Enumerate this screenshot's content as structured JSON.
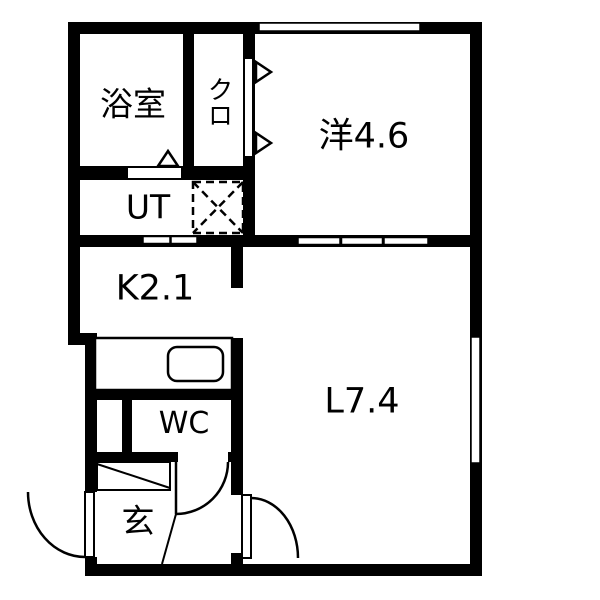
{
  "title": "apartment-floorplan",
  "colors": {
    "wall": "#000000",
    "background": "#ffffff",
    "line": "#000000"
  },
  "rooms": {
    "bathroom": {
      "label": "浴室"
    },
    "closet": {
      "label": "クロ"
    },
    "western_room": {
      "label": "洋4.6"
    },
    "utility": {
      "label": "UT"
    },
    "kitchen": {
      "label": "K2.1"
    },
    "living": {
      "label": "L7.4"
    },
    "toilet": {
      "label": "WC"
    },
    "entrance": {
      "label": "玄"
    }
  },
  "fixtures": {
    "kitchen_sink": "kitchen-sink-icon",
    "washing_machine_space": "washing-machine-cross-box",
    "entrance_door": "swing-door-arc",
    "toilet_door": "swing-door-arc",
    "living_door": "swing-door-arc",
    "bath_door": "triangle-door-mark",
    "closet_door": "folding-door-triangle-marks",
    "top_window": "sliding-window",
    "right_window": "sliding-window",
    "room_partition_sliding_doors": "sliding-panels"
  }
}
